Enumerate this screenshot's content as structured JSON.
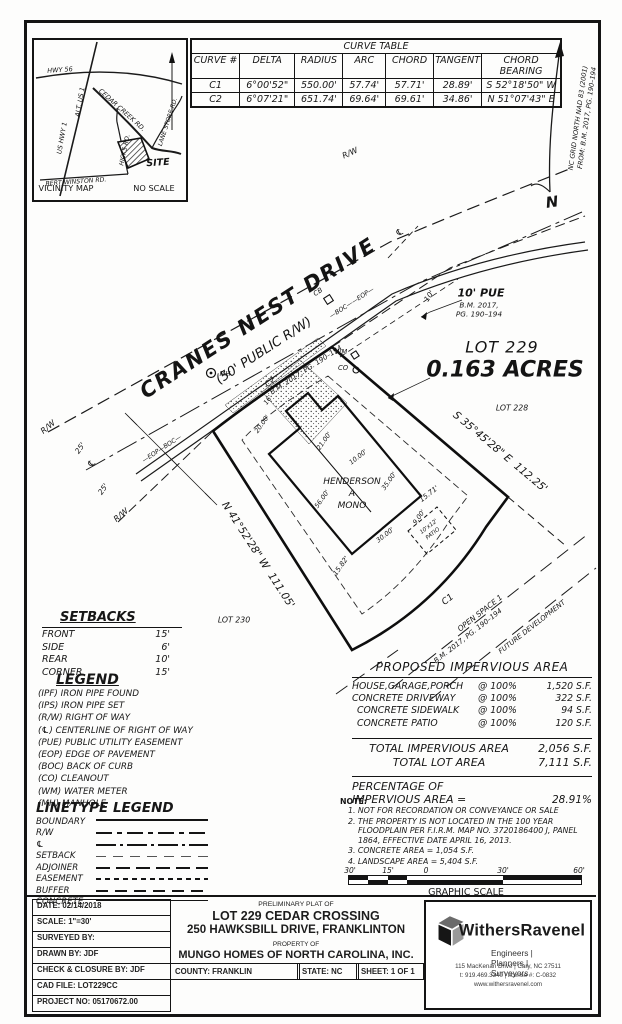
{
  "vicinity": {
    "title": "VICINITY MAP",
    "no_scale": "NO SCALE",
    "site": "SITE",
    "roads": {
      "hwy56": "HWY 56",
      "alt_us1": "ALT. US 1",
      "us_hwy1": "US HWY 1",
      "cedar_creek": "CEDAR CREEK RD.",
      "lane_store": "LANE STORE RD.",
      "bert_winston": "BERT WINSTON RD.",
      "hicks": "HICKS RD."
    }
  },
  "curve_table": {
    "title": "CURVE TABLE",
    "headers": [
      "CURVE #",
      "DELTA",
      "RADIUS",
      "ARC",
      "CHORD",
      "TANGENT",
      "CHORD BEARING"
    ],
    "rows": [
      [
        "C1",
        "6°00'52\"",
        "550.00'",
        "57.74'",
        "57.71'",
        "28.89'",
        "S 52°18'50\" W"
      ],
      [
        "C2",
        "6°07'21\"",
        "651.74'",
        "69.64'",
        "69.61'",
        "34.86'",
        "N 51°07'43\" E"
      ]
    ]
  },
  "north": {
    "n": "N",
    "note_line1": "NC GRID NORTH NAD 83 (2001)",
    "note_line2": "FROM: B.M. 2017, PG. 190–194"
  },
  "plat": {
    "street": {
      "name": "CRANES NEST DRIVE",
      "rw": "(50' PUBLIC R/W)",
      "ref": "B.M. 2017, PG. 190–194"
    },
    "lot": {
      "number": "LOT 229",
      "area": "0.163 ACRES"
    },
    "adjoining": {
      "lot228": "LOT 228",
      "lot230": "LOT 230"
    },
    "bearing_ne": "S 35°45'28\" E  112.25'",
    "bearing_sw": "N 41°52'28\" W  111.05'",
    "house": {
      "l1": "HENDERSON",
      "l2": "A",
      "l3": "MONO"
    },
    "patio_l1": "10'x12'",
    "patio_l2": "PATIO",
    "pue": {
      "label": "10' PUE",
      "ref1": "B.M. 2017,",
      "ref2": "PG. 190–194",
      "tick": "10'"
    },
    "open_space": {
      "c1": "C1",
      "name": "OPEN SPACE 1",
      "ref": "B.M. 2017, PG. 190–194",
      "future": "FUTURE DEVELOPMENT"
    },
    "dims": {
      "d1": "20.00'",
      "d2": "16'",
      "d3": "C2",
      "d4": "21.00'",
      "d5": "10.00'",
      "d6": "35.00'",
      "d7": "56.00'",
      "d8": "30.00'",
      "d9": "9.00'",
      "d10": "15.82'",
      "d11": "15.71'"
    },
    "marks": {
      "rw": "R/W",
      "cl": "℄",
      "offset_a": "25'",
      "offset_b": "25'",
      "eop_boc": "—EOP—BOC—",
      "boc_eop": "—BOC——EOP—",
      "cb": "CB",
      "mh": "MH",
      "wm": "WM",
      "co": "CO"
    }
  },
  "setbacks": {
    "title": "SETBACKS",
    "rows": [
      {
        "k": "FRONT",
        "v": "15'"
      },
      {
        "k": "SIDE",
        "v": "6'"
      },
      {
        "k": "REAR",
        "v": "10'"
      },
      {
        "k": "CORNER",
        "v": "15'"
      }
    ]
  },
  "legend": {
    "title": "LEGEND",
    "items": [
      "(IPF)  IRON PIPE FOUND",
      "(IPS)  IRON PIPE SET",
      "(R/W)  RIGHT OF WAY",
      "(℄)  CENTERLINE OF RIGHT OF WAY",
      "(PUE)  PUBLIC UTILITY EASEMENT",
      "(EOP)  EDGE OF PAVEMENT",
      "(BOC)  BACK OF CURB",
      "(CO)  CLEANOUT",
      "(WM)  WATER METER",
      "(MH)  MANHOLE"
    ]
  },
  "linetypes": {
    "title": "LINETYPE LEGEND",
    "items": [
      "BOUNDARY",
      "R/W",
      "℄",
      "SETBACK",
      "ADJOINER",
      "EASEMENT",
      "BUFFER",
      "CONCRETE"
    ]
  },
  "impervious": {
    "title": "PROPOSED IMPERVIOUS AREA",
    "rows": [
      {
        "name": "HOUSE,GARAGE,PORCH",
        "rate": "@  100%",
        "area": "1,520  S.F."
      },
      {
        "name": "CONCRETE DRIVEWAY",
        "rate": "@  100%",
        "area": "322  S.F."
      },
      {
        "name": "CONCRETE SIDEWALK",
        "rate": "@  100%",
        "area": "94  S.F."
      },
      {
        "name": "CONCRETE PATIO",
        "rate": "@  100%",
        "area": "120  S.F."
      }
    ],
    "total1_label": "TOTAL IMPERVIOUS AREA",
    "total1_value": "2,056  S.F.",
    "total2_label": "TOTAL LOT AREA",
    "total2_value": "7,111  S.F.",
    "pct_l1": "PERCENTAGE OF",
    "pct_l2": "IMPERVIOUS AREA =",
    "pct_value": "28.91%"
  },
  "notes": {
    "title": "NOTE:",
    "items": [
      "1.  NOT FOR RECORDATION OR CONVEYANCE OR SALE",
      "2.  THE PROPERTY IS NOT LOCATED IN THE 100 YEAR FLOODPLAIN PER F.I.R.M. MAP NO. 3720186400 J, PANEL 1864, EFFECTIVE DATE APRIL 16, 2013.",
      "3.  CONCRETE AREA =    1,054  S.F.",
      "4.  LANDSCAPE AREA =  5,404  S.F."
    ]
  },
  "scalebar": {
    "t1": "30'",
    "t2": "15'",
    "t3": "0",
    "t4": "30'",
    "t5": "60'",
    "label": "GRAPHIC SCALE"
  },
  "titleblock": {
    "rows": [
      "DATE: 02/14/2018",
      "SCALE: 1\"=30'",
      "SURVEYED BY:",
      "DRAWN BY: JDF",
      "CHECK & CLOSURE BY: JDF",
      "CAD FILE: LOT229CC",
      "PROJECT NO: 05170672.00"
    ],
    "pre": "PRELIMINARY PLAT OF",
    "title1": "LOT 229 CEDAR CROSSING",
    "title2": "250 HAWKSBILL DRIVE, FRANKLINTON",
    "prop": "PROPERTY OF",
    "owner": "MUNGO HOMES OF NORTH CAROLINA, INC.",
    "county": "COUNTY: FRANKLIN",
    "state": "STATE: NC",
    "sheet": "SHEET: 1 OF 1"
  },
  "firm": {
    "name": "WithersRavenel",
    "tagline": "Engineers | Planners | Surveyors",
    "address": "115 MacKenan Drive | Cary, NC 27511",
    "phone": "t: 919.469.3340 | license #: C-0832",
    "web": "www.withersravenel.com"
  }
}
